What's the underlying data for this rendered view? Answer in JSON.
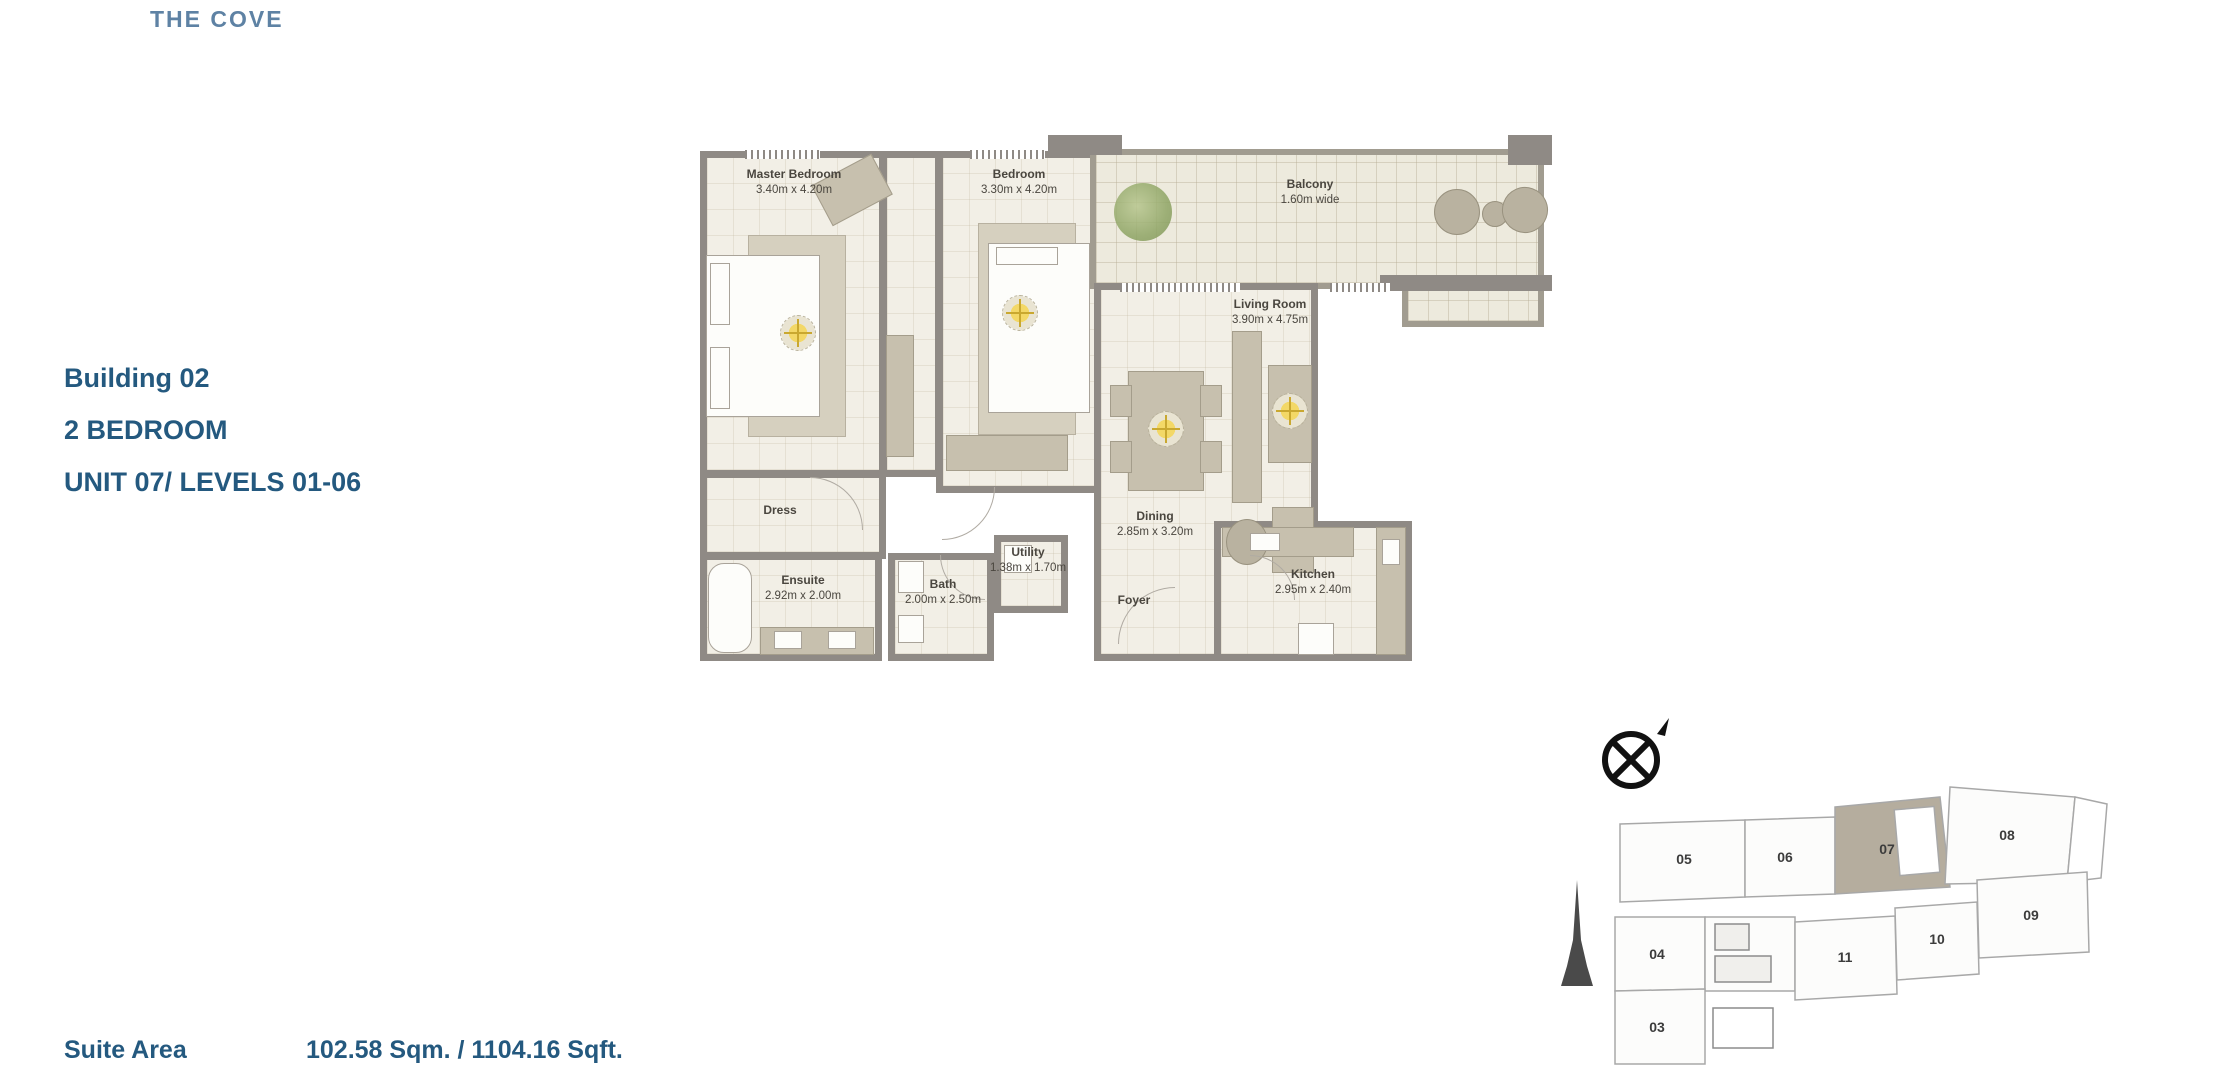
{
  "page": {
    "title": "THE COVE"
  },
  "info": {
    "building": "Building 02",
    "type": "2 BEDROOM",
    "unit": "UNIT 07/ LEVELS 01-06"
  },
  "floorplan": {
    "rooms": {
      "master": {
        "name": "Master Bedroom",
        "dims": "3.40m x 4.20m"
      },
      "bedroom": {
        "name": "Bedroom",
        "dims": "3.30m x 4.20m"
      },
      "balcony": {
        "name": "Balcony",
        "dims": "1.60m wide"
      },
      "living": {
        "name": "Living Room",
        "dims": "3.90m x 4.75m"
      },
      "dining": {
        "name": "Dining",
        "dims": "2.85m x 3.20m"
      },
      "dress": {
        "name": "Dress"
      },
      "ensuite": {
        "name": "Ensuite",
        "dims": "2.92m x 2.00m"
      },
      "bath": {
        "name": "Bath",
        "dims": "2.00m x 2.50m"
      },
      "utility": {
        "name": "Utility",
        "dims": "1.38m x 1.70m"
      },
      "foyer": {
        "name": "Foyer"
      },
      "kitchen": {
        "name": "Kitchen",
        "dims": "2.95m x 2.40m"
      }
    }
  },
  "keyplan": {
    "highlighted_unit": "07",
    "units": [
      "05",
      "06",
      "07",
      "08",
      "09",
      "10",
      "11",
      "04",
      "03"
    ]
  },
  "footer": {
    "suite_area_label": "Suite Area",
    "suite_area_value": "102.58 Sqm. / 1104.16 Sqft."
  },
  "colors": {
    "title_blue": "#5e82a4",
    "accent_blue": "#24597f",
    "wall_gray": "#8f8a85",
    "floor_cream": "#f2efe6",
    "furniture_tan": "#c7c0ae",
    "keyplan_highlight": "#b5ad9e",
    "fan_yellow": "#f3d867",
    "plant_green": "#8fa565"
  }
}
